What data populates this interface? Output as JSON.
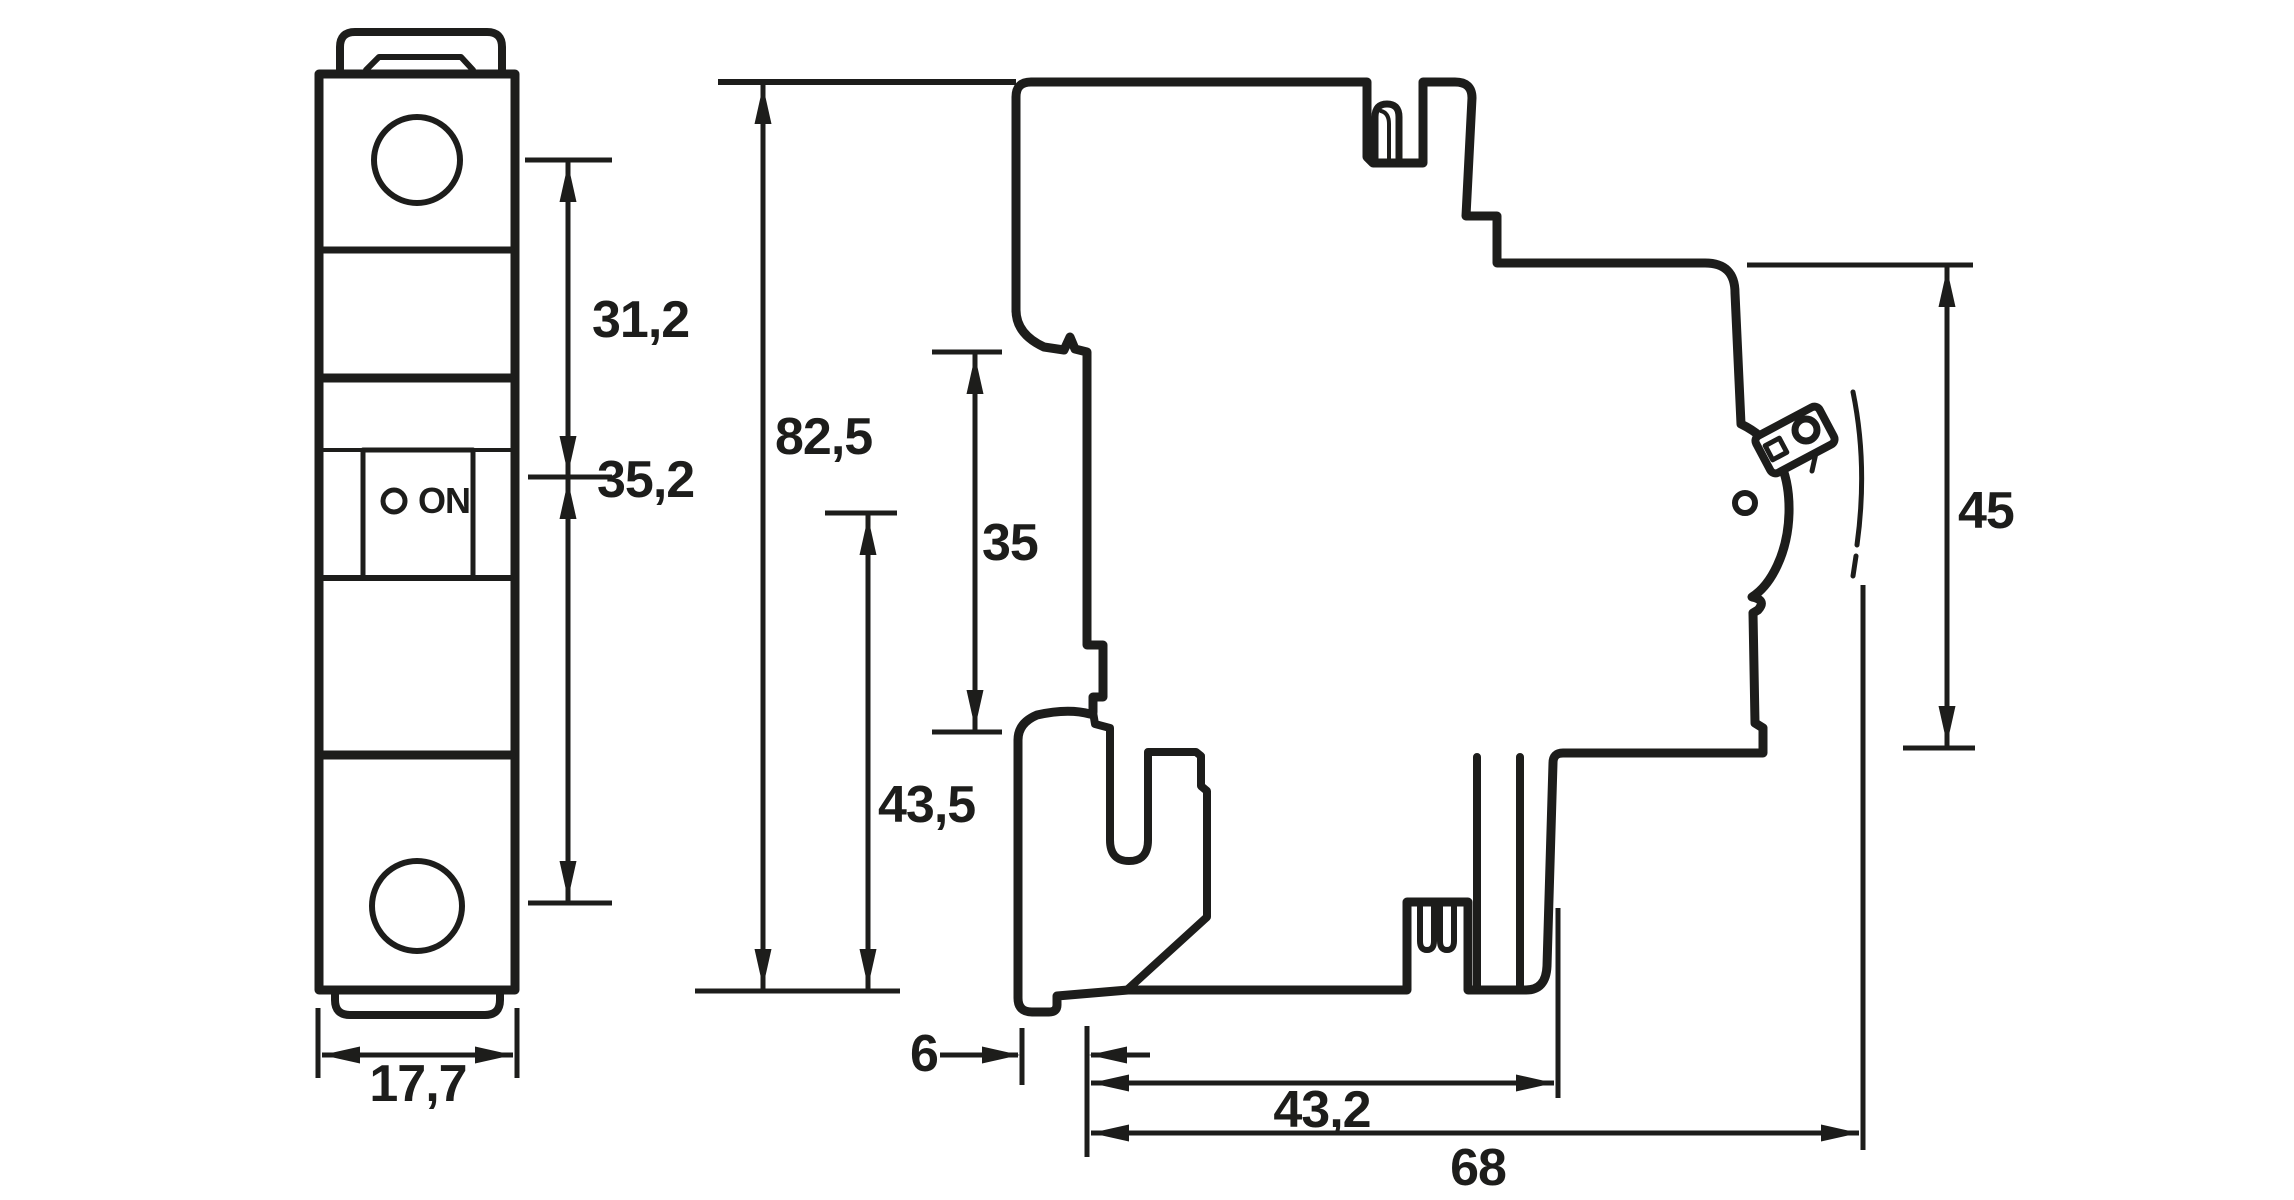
{
  "drawing": {
    "background": "#ffffff",
    "line_color": "#1d1d1b",
    "front_view": {
      "name": "circuit-breaker-front-view",
      "switch": {
        "label": "ON"
      },
      "dimensions": {
        "upper_height": {
          "label": "31,2"
        },
        "lower_height": {
          "label": "35,2"
        },
        "width": {
          "label": "17,7"
        }
      }
    },
    "side_view": {
      "name": "circuit-breaker-side-view",
      "dimensions": {
        "total_height": {
          "label": "82,5"
        },
        "rail_height": {
          "label": "35"
        },
        "lower_height": {
          "label": "43,5"
        },
        "rail_offset": {
          "label": "6"
        },
        "depth_to_rail_clip": {
          "label": "43,2"
        },
        "total_depth": {
          "label": "68"
        },
        "front_height": {
          "label": "45"
        }
      }
    }
  }
}
